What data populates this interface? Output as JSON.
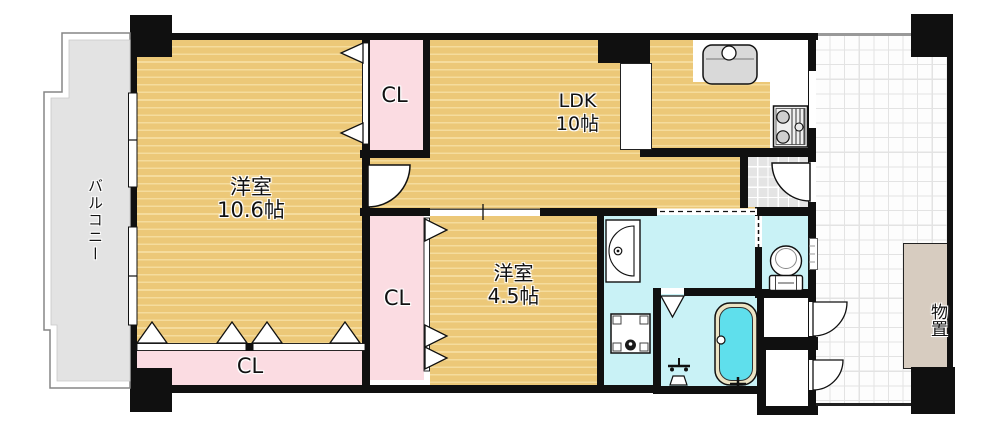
{
  "floorplan": {
    "type": "japanese-apartment-floor-plan",
    "balcony": {
      "label": "バルコニー"
    },
    "room_main": {
      "name": "洋室",
      "size": "10.6帖"
    },
    "ldk": {
      "name": "LDK",
      "size": "10帖"
    },
    "room_small": {
      "name": "洋室",
      "size": "4.5帖"
    },
    "closet_top": {
      "label": "CL"
    },
    "closet_middle": {
      "label": "CL"
    },
    "closet_bottom": {
      "label": "CL"
    },
    "storage": {
      "label": "物置"
    },
    "fixtures": [
      "kitchen-sink",
      "gas-stove",
      "kitchen-counter",
      "washbasin",
      "washing-machine",
      "toilet",
      "bathtub",
      "shower",
      "entrance-door",
      "room-door",
      "folding-closet-doors",
      "sliding-doors",
      "windows",
      "corridor-closet-doors"
    ],
    "colors": {
      "floor_tan": "#ecc878",
      "floor_stripe": "#f5dc9d",
      "closet_pink": "#fbdce2",
      "wet_area_cyan": "#c9f2f6",
      "bath_water": "#5fdfec",
      "balcony_gray": "#e3e3e3",
      "storage_beige": "#d7ccc0",
      "wall_black": "#101010"
    }
  }
}
